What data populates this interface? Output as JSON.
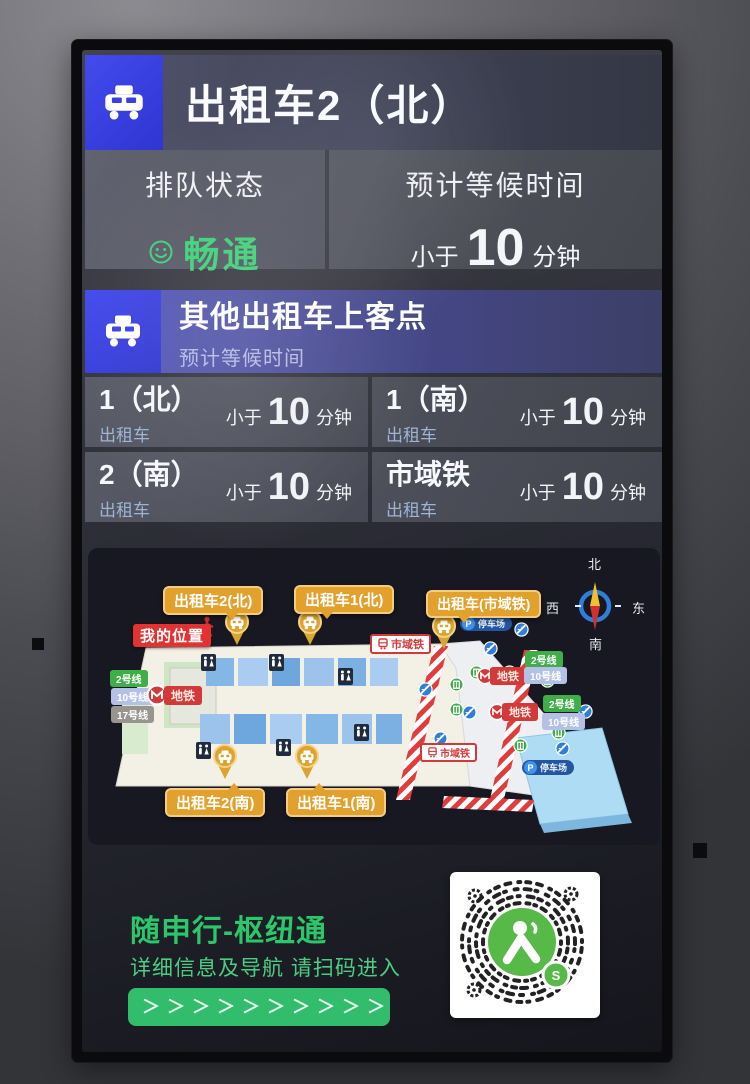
{
  "screen": {
    "main": {
      "title": "出租车2（北）"
    },
    "status": {
      "queue_label": "排队状态",
      "queue_value": "畅通",
      "wait_label": "预计等候时间",
      "wait_prefix": "小于",
      "wait_value": "10",
      "wait_unit": "分钟"
    },
    "other": {
      "title": "其他出租车上客点",
      "subtitle": "预计等候时间",
      "items": [
        {
          "name": "1（北）",
          "category": "出租车",
          "wait_prefix": "小于",
          "wait_value": "10",
          "wait_unit": "分钟"
        },
        {
          "name": "1（南）",
          "category": "出租车",
          "wait_prefix": "小于",
          "wait_value": "10",
          "wait_unit": "分钟"
        },
        {
          "name": "2（南）",
          "category": "出租车",
          "wait_prefix": "小于",
          "wait_value": "10",
          "wait_unit": "分钟"
        },
        {
          "name": "市域铁",
          "category": "出租车",
          "wait_prefix": "小于",
          "wait_value": "10",
          "wait_unit": "分钟"
        }
      ]
    },
    "map": {
      "pickups": {
        "north2": "出租车2(北)",
        "north1": "出租车1(北)",
        "suburban": "出租车(市域铁)",
        "south2": "出租车2(南)",
        "south1": "出租车1(南)"
      },
      "my_location": "我的位置",
      "lines": {
        "line2": "2号线",
        "line10": "10号线",
        "line17": "17号线"
      },
      "metro": "地铁",
      "suburban_rail": "市域铁",
      "parking": "停车场",
      "compass": {
        "n": "北",
        "s": "南",
        "e": "东",
        "w": "西"
      }
    },
    "footer": {
      "title": "随申行-枢纽通",
      "subtitle": "详细信息及导航 请扫码进入",
      "chevrons": "＞＞＞＞＞＞＞＞＞＞"
    }
  },
  "colors": {
    "accent_blue": "#3a43e0",
    "header_purple": "#474a90",
    "status_green": "#3ed277",
    "footer_green": "#2cc76a",
    "bubble_amber": "#e2a02c",
    "alert_red": "#e23333",
    "line2_green": "#3fae49",
    "line10_blue": "#b4c0e6",
    "line17_gray": "#98948e"
  }
}
